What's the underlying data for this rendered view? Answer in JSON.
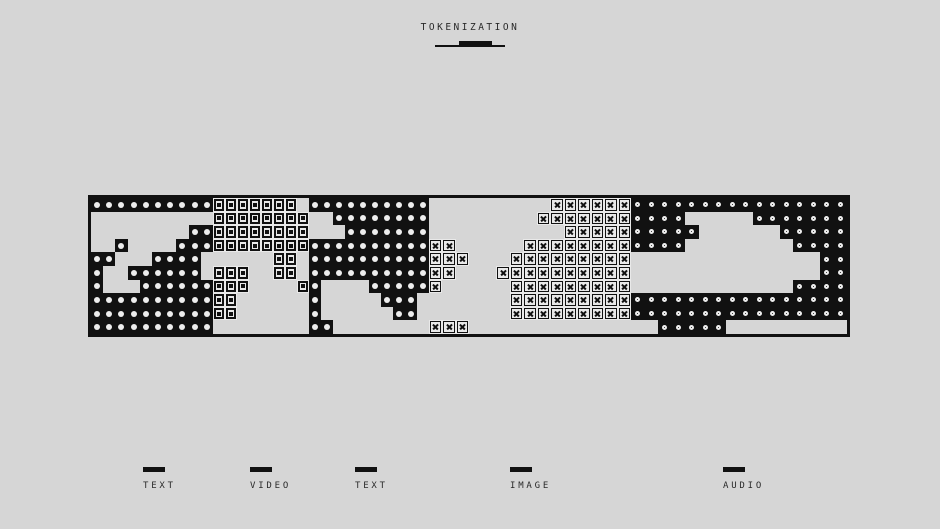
{
  "title": "TOKENIZATION",
  "colors": {
    "background": "#d6d6d6",
    "ink": "#111111",
    "token_fill": "#e9e9e9",
    "glyph_light": "#ededed"
  },
  "strip": {
    "segments": [
      {
        "id": "text-1",
        "label": "TEXT",
        "glyph": "dot",
        "theme": "dark",
        "cols": 10,
        "width": 122,
        "bitmap": [
          "1111111111",
          "0000000000",
          "0000000011",
          "0010000111",
          "1100011110",
          "1001111110",
          "1000111111",
          "1111111111",
          "1111111111",
          "1111111111"
        ]
      },
      {
        "id": "video",
        "label": "VIDEO",
        "glyph": "square",
        "theme": "light",
        "cols": 8,
        "width": 96,
        "bitmap": [
          "11111110",
          "11111111",
          "11111111",
          "11111111",
          "00000110",
          "11100110",
          "11100001",
          "11000000",
          "11000000",
          "00000000"
        ]
      },
      {
        "id": "text-2",
        "label": "TEXT",
        "glyph": "dot",
        "theme": "dark",
        "cols": 10,
        "width": 120,
        "bitmap": [
          "1111111111",
          "0011111111",
          "0001111111",
          "1111111111",
          "1111111111",
          "1111111111",
          "1000011111",
          "1000001110",
          "1000000110",
          "1100000000"
        ]
      },
      {
        "id": "image",
        "label": "IMAGE",
        "glyph": "cross",
        "theme": "light",
        "cols": 15,
        "width": 202,
        "bitmap": [
          "000000000111111",
          "000000001111111",
          "000000000011111",
          "110000011111111",
          "111000111111111",
          "110001111111111",
          "100000111111111",
          "000000111111111",
          "000000111111111",
          "111000000000000"
        ]
      },
      {
        "id": "audio",
        "label": "AUDIO",
        "glyph": "ring",
        "theme": "dark",
        "cols": 16,
        "width": 216,
        "bitmap": [
          "1111111111111111",
          "1111000001111111",
          "1111100000011111",
          "1111000000001111",
          "0000000000000011",
          "0000000000000011",
          "0000000000001111",
          "1111111111111111",
          "1111111111111111",
          "0011111000000000"
        ]
      }
    ]
  },
  "legend": {
    "items": [
      {
        "label": "TEXT",
        "x": 143
      },
      {
        "label": "VIDEO",
        "x": 250
      },
      {
        "label": "TEXT",
        "x": 355
      },
      {
        "label": "IMAGE",
        "x": 510
      },
      {
        "label": "AUDIO",
        "x": 723
      }
    ]
  }
}
